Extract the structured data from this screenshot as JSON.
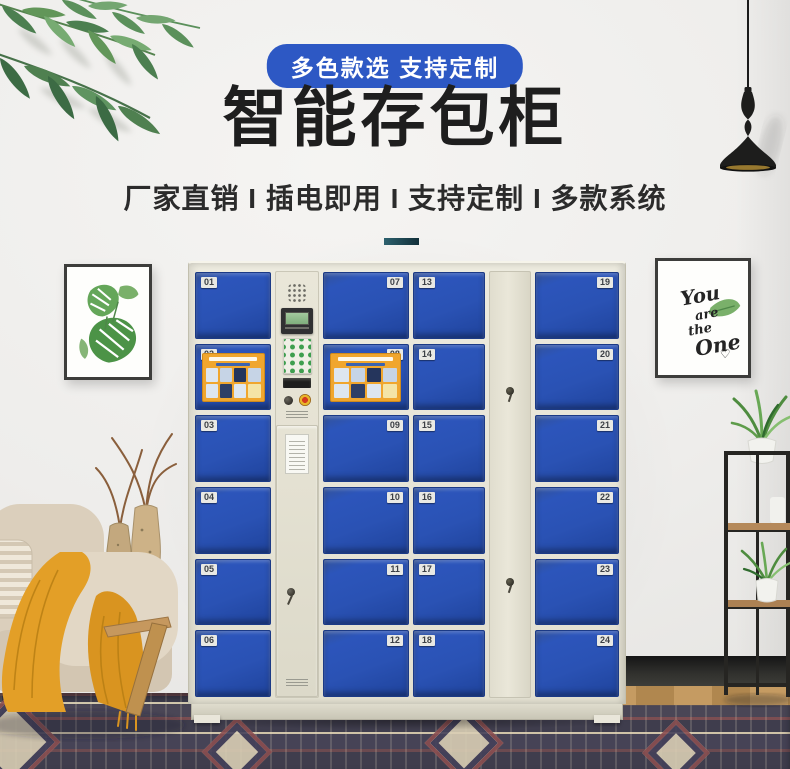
{
  "badge": {
    "label": "多色款选 支持定制"
  },
  "hero": {
    "title": "智能存包柜",
    "subtitle": "厂家直销 I 插电即用 I 支持定制 I 多款系统"
  },
  "frames": {
    "right": {
      "line1": "You",
      "line2": "are",
      "line3": "the",
      "line4": "One",
      "heart": "♡"
    }
  },
  "locker": {
    "columns": [
      {
        "kind": "doors",
        "label_side": "left",
        "doors": [
          {
            "num": "01"
          },
          {
            "num": "02",
            "poster": true
          },
          {
            "num": "03"
          },
          {
            "num": "04"
          },
          {
            "num": "05"
          },
          {
            "num": "06"
          }
        ]
      },
      {
        "kind": "control"
      },
      {
        "kind": "doors",
        "label_side": "right",
        "doors": [
          {
            "num": "07"
          },
          {
            "num": "08",
            "poster": true
          },
          {
            "num": "09"
          },
          {
            "num": "10"
          },
          {
            "num": "11"
          },
          {
            "num": "12"
          }
        ]
      },
      {
        "kind": "doors",
        "label_side": "left",
        "doors": [
          {
            "num": "13"
          },
          {
            "num": "14"
          },
          {
            "num": "15"
          },
          {
            "num": "16"
          },
          {
            "num": "17"
          },
          {
            "num": "18"
          }
        ]
      },
      {
        "kind": "panel"
      },
      {
        "kind": "doors",
        "label_side": "right",
        "doors": [
          {
            "num": "19"
          },
          {
            "num": "20"
          },
          {
            "num": "21"
          },
          {
            "num": "22"
          },
          {
            "num": "23"
          },
          {
            "num": "24"
          }
        ]
      }
    ]
  },
  "colors": {
    "badge_blue": "#2d58c4",
    "door_blue": "#2a52b4",
    "cabinet_beige": "#e5e2d3",
    "divider_teal": "#1d4c59",
    "poster_orange": "#f0a62e",
    "throw_mustard": "#e29d27",
    "title_black": "#1e1e1e"
  }
}
